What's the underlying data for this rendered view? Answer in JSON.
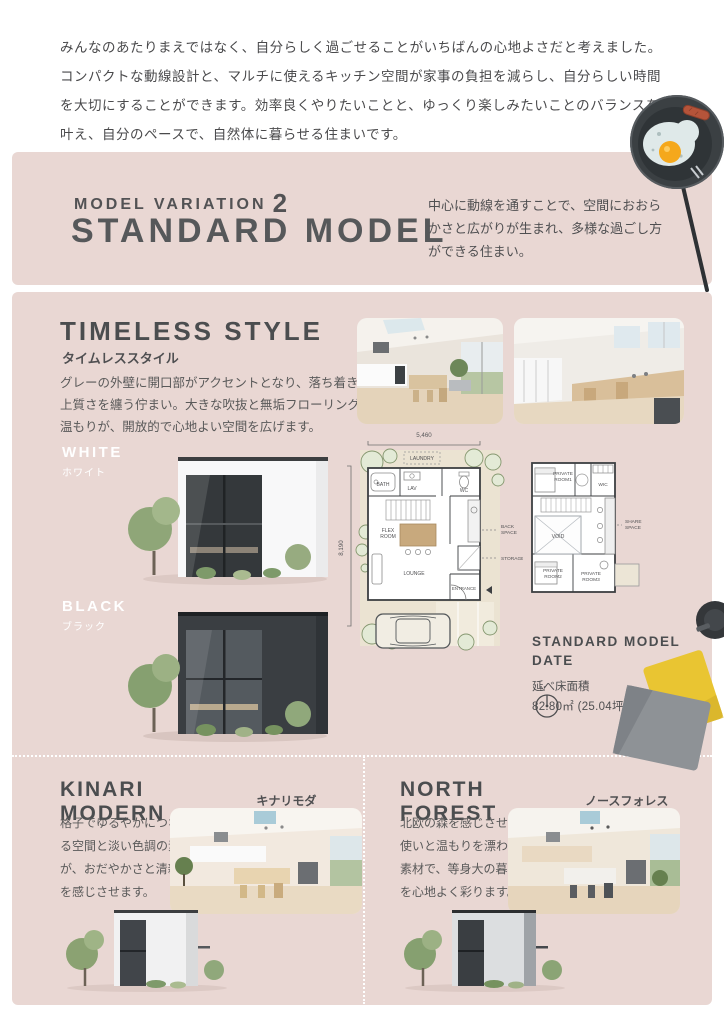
{
  "intro": {
    "text": "みんなのあたりまえではなく、自分らしく過ごせることがいちばんの心地よさだと考えました。コンパクトな動線設計と、マルチに使えるキッチン空間が家事の負担を減らし、自分らしい時間を大切にすることができます。効率良くやりたいことと、ゆっくり楽しみたいことのバランスを叶え、自分のペースで、自然体に暮らせる住まいです。"
  },
  "header": {
    "eyebrow": "MODEL VARIATION",
    "eyebrow_number": "2",
    "title": "STANDARD MODEL",
    "description": "中心に動線を通すことで、空間におおらかさと広がりが生まれ、多様な過ごし方ができる住まい。"
  },
  "timeless": {
    "title": "TIMELESS STYLE",
    "subtitle": "タイムレススタイル",
    "description": "グレーの外壁に開口部がアクセントとなり、落ち着きと上質さを纏う佇まい。大きな吹抜と無垢フローリングの温もりが、開放的で心地よい空間を広げます。",
    "white_label": "WHITE",
    "white_label_ja": "ホワイト",
    "black_label": "BLACK",
    "black_label_ja": "ブラック"
  },
  "floorplan": {
    "dim_width": "5,460",
    "dim_height": "8,190",
    "laundry": "LAUNDRY",
    "bath": "BATH",
    "lav": "LAV",
    "wc": "WC",
    "flex_room": "FLEX ROOM",
    "lounge": "LOUNGE",
    "entrance": "ENTRANCE",
    "back_space": "BACK SPACE",
    "storage": "STORAGE",
    "private_room1": "PRIVATE ROOM1",
    "wic": "WIC",
    "void": "VOID",
    "share_space": "SHARE SPACE",
    "private_room2": "PRIVATE ROOM2",
    "private_room3": "PRIVATE ROOM3",
    "compass_n": "N"
  },
  "model_data": {
    "title": "STANDARD MODEL DATE",
    "area_label": "延べ床面積",
    "area_value": "82.80㎡ (25.04坪)"
  },
  "kinari": {
    "title": "KINARI MODERN",
    "subtitle": "キナリモダン",
    "description": "格子でゆるやかにつながる空間と淡い色調の素材が、おだやかさと清新さを感じさせます。"
  },
  "north": {
    "title": "NORTH FOREST",
    "subtitle": "ノースフォレスト",
    "description": "北欧の森を感じさせる色使いと温もりを漂わせる素材で、等身大の暮らしを心地よく彩ります。"
  },
  "colors": {
    "pink_bg": "#e9d7d3",
    "heading_text": "#4b4d4f",
    "body_text": "#595959",
    "plan_site": "#ebe3d2",
    "plan_wall": "#3c3f42",
    "cushion_yellow": "#e9c532",
    "cushion_gray": "#8e9296",
    "egg_yolk": "#f5a81c"
  }
}
